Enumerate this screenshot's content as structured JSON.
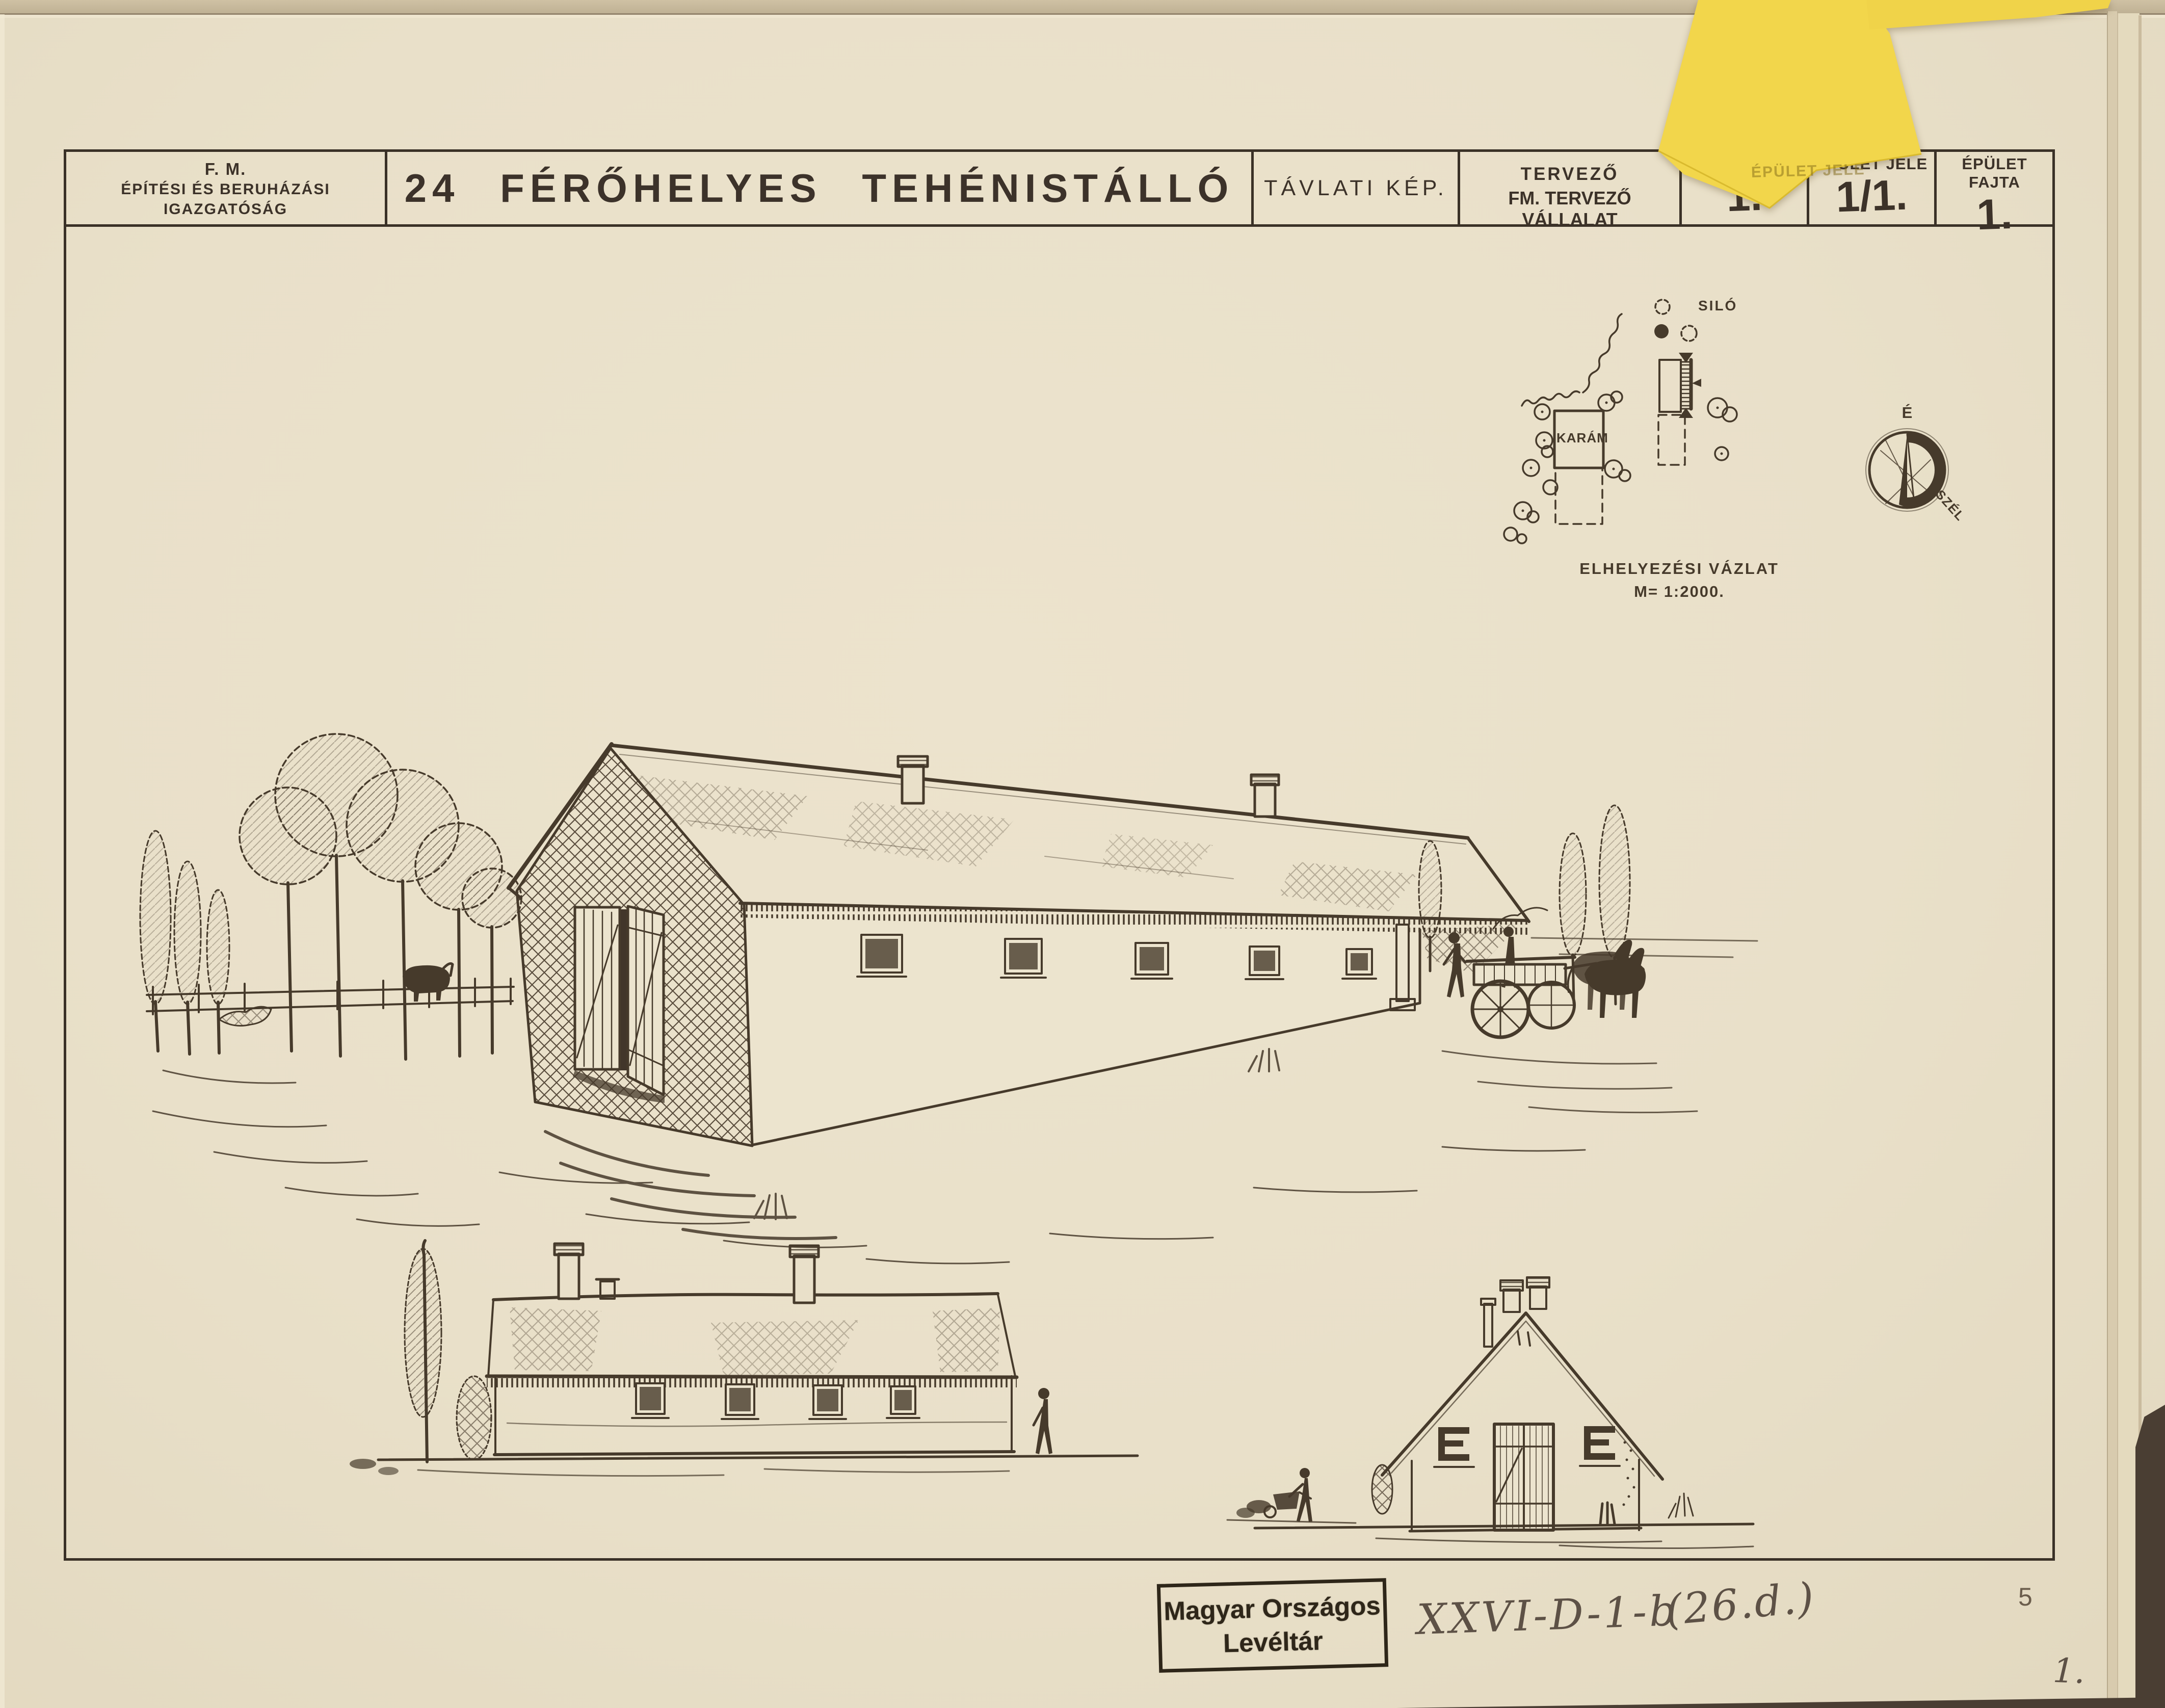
{
  "colors": {
    "paper": "#e9e0c9",
    "ink": "#463a2b",
    "frame": "#3a3127",
    "sticky_note": "#f2d64b",
    "pencil": "#5d5146",
    "backdrop": "#4a3e33"
  },
  "title_block": {
    "org_line1": "F. M.",
    "org_line2": "ÉPÍTÉSI ÉS BERUHÁZÁSI",
    "org_line3": "IGAZGATÓSÁG",
    "title": "24 FÉRŐHELYES TEHÉNISTÁLLÓ",
    "view_label": "TÁVLATI KÉP.",
    "designer_label": "TERVEZŐ",
    "designer_value": "FM. TERVEZŐ VÁLLALAT",
    "drawing_number_label": "RAJZSZÁM",
    "drawing_number_value": "1.",
    "building_mark_label": "ÉPÜLET JELE",
    "building_mark_value": "1/1.",
    "building_type_label": "ÉPÜLET FAJTA",
    "building_type_value": "1."
  },
  "site_plan": {
    "silo_label": "SILÓ",
    "pen_label": "KARÁM",
    "caption_title": "ELHELYEZÉSI VÁZLAT",
    "caption_scale": "M= 1:2000.",
    "compass_north": "É",
    "compass_wind": "SZÉL"
  },
  "footer": {
    "stamp_line1": "Magyar Országos",
    "stamp_line2": "Levéltár",
    "archive_code": "XXVI-D-1-b",
    "archive_code_alt": "(26.d.)",
    "sheet_number": "5",
    "page_number": "1."
  }
}
